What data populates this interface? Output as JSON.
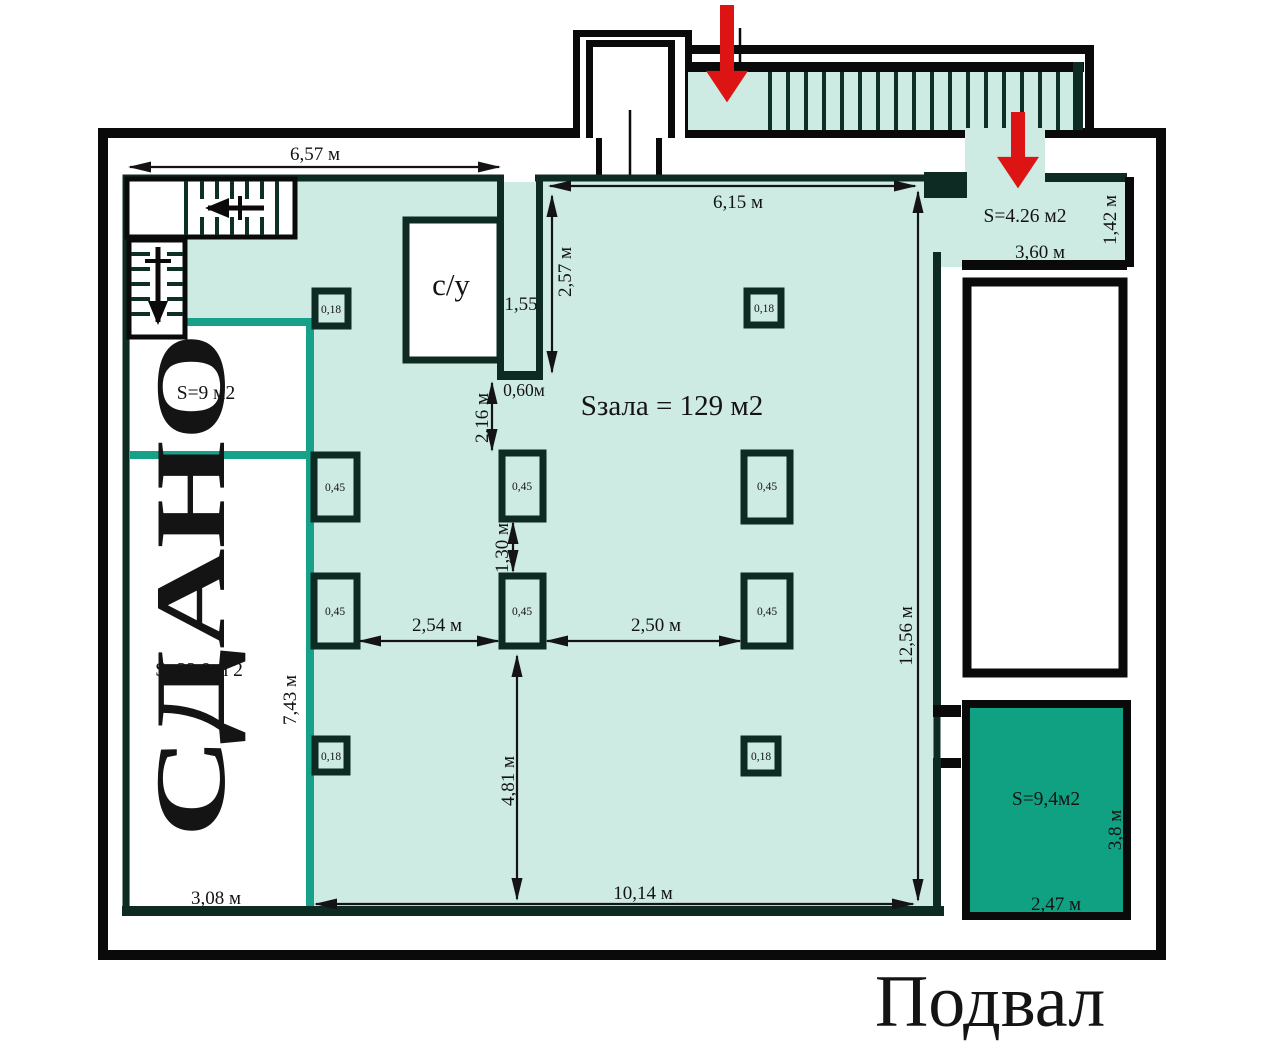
{
  "title": "Подвал",
  "rooms": {
    "hall": "Sзала = 129 м2",
    "rented_status": "СДАНО",
    "rented_top_area": "S=9 м2",
    "rented_area": "S=22.9 м 2",
    "wc": "с/у",
    "entry": "S=4.26 м2",
    "back_room": "S=9,4м2"
  },
  "dims": {
    "d657": "6,57 м",
    "d615": "6,15 м",
    "d257": "2,57 м",
    "d155": "1,55",
    "d060": "0,60м",
    "d216": "2,16 м",
    "d130": "1,30 м",
    "d254": "2,54 м",
    "d250": "2,50 м",
    "d481": "4,81 м",
    "d1014": "10,14 м",
    "d1256": "12,56 м",
    "d743": "7,43 м",
    "d308": "3,08 м",
    "d360": "3,60 м",
    "d142": "1,42 м",
    "d247": "2,47 м",
    "d38": "3,8 м"
  },
  "columns": {
    "small": "0,18",
    "large": "0,45"
  },
  "colors": {
    "floor_teal": "#cdeae3",
    "outline_dark": "#0d2b22",
    "divider_green": "#18a189",
    "back_room_green": "#0fa182",
    "accent_red": "#dd1414",
    "wall_black": "#0a0a0a"
  }
}
